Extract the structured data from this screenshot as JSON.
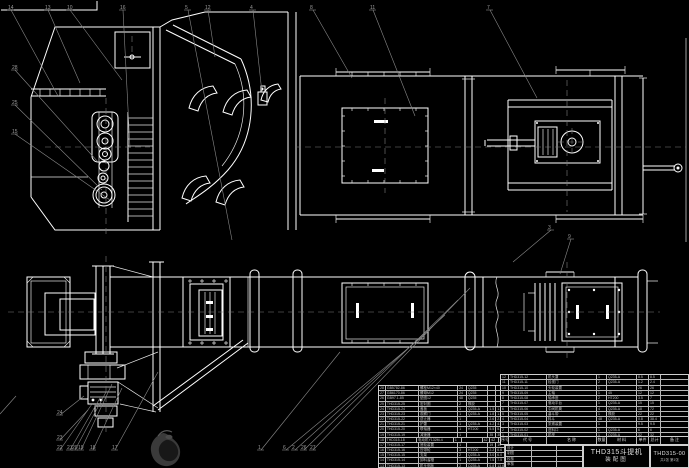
{
  "meta": {
    "background": "#000000",
    "line_color": "#ffffff",
    "callout_color": "#8a8a8a",
    "table_line_color": "#cfcfcf"
  },
  "title_block": {
    "product_title": "THD315斗提机",
    "drawing_type": "装配图",
    "drawing_no": "THD315-00",
    "sheet_info": "共1张 第1张",
    "signature_labels": [
      "设计",
      "制图",
      "校核",
      "审核"
    ]
  },
  "bom": {
    "header": [
      "序号",
      "代 号",
      "名 称",
      "数量",
      "材 料",
      "单件",
      "总计",
      "备 注"
    ],
    "right_rows": [
      {
        "seq": "12",
        "code": "THD315-12",
        "name": "机头罩",
        "qty": "1",
        "material": "Q235-A",
        "w1": "8.5",
        "w2": "8.5",
        "remark": ""
      },
      {
        "seq": "11",
        "code": "THD315-11",
        "name": "检视门",
        "qty": "2",
        "material": "Q235-A",
        "w1": "1.2",
        "w2": "2.4",
        "remark": ""
      },
      {
        "seq": "10",
        "code": "THD315-10",
        "name": "头轮装置",
        "qty": "1",
        "material": "",
        "w1": "26",
        "w2": "26",
        "remark": ""
      },
      {
        "seq": "9",
        "code": "THD315-09",
        "name": "主轴",
        "qty": "1",
        "material": "45",
        "w1": "12",
        "w2": "12",
        "remark": ""
      },
      {
        "seq": "8",
        "code": "THD315-08",
        "name": "轴承座",
        "qty": "2",
        "material": "HT200",
        "w1": "3.5",
        "w2": "7",
        "remark": ""
      },
      {
        "seq": "7",
        "code": "THD315-07",
        "name": "驱动平台",
        "qty": "1",
        "material": "Q235-A",
        "w1": "15",
        "w2": "15",
        "remark": ""
      },
      {
        "seq": "6",
        "code": "THD315-06",
        "name": "中间机筒",
        "qty": "4",
        "material": "Q235-A",
        "w1": "18",
        "w2": "72",
        "remark": ""
      },
      {
        "seq": "5",
        "code": "THD315-05",
        "name": "畚斗带",
        "qty": "1",
        "material": "橡胶",
        "w1": "22",
        "w2": "22",
        "remark": ""
      },
      {
        "seq": "4",
        "code": "THD315-04",
        "name": "料斗",
        "qty": "48",
        "material": "Q235-A",
        "w1": "0.8",
        "w2": "38.4",
        "remark": ""
      },
      {
        "seq": "3",
        "code": "THD315-03",
        "name": "张紧装置",
        "qty": "1",
        "material": "",
        "w1": "9.5",
        "w2": "9.5",
        "remark": ""
      },
      {
        "seq": "2",
        "code": "THD315-02",
        "name": "进料口",
        "qty": "1",
        "material": "Q235-A",
        "w1": "6",
        "w2": "6",
        "remark": ""
      },
      {
        "seq": "1",
        "code": "THD315-01",
        "name": "机座",
        "qty": "1",
        "material": "Q235-A",
        "w1": "32",
        "w2": "32",
        "remark": ""
      }
    ],
    "left_rows": [
      {
        "seq": "28",
        "code": "GB5782-86",
        "name": "螺栓M12×40",
        "qty": "24",
        "material": "Q235",
        "w1": "",
        "w2": "",
        "remark": ""
      },
      {
        "seq": "27",
        "code": "GB6170-86",
        "name": "螺母M12",
        "qty": "24",
        "material": "Q235",
        "w1": "",
        "w2": "",
        "remark": ""
      },
      {
        "seq": "26",
        "code": "GB97.1-85",
        "name": "垫圈12",
        "qty": "48",
        "material": "Q235",
        "w1": "",
        "w2": "",
        "remark": ""
      },
      {
        "seq": "25",
        "code": "THD315-25",
        "name": "密封圈",
        "qty": "2",
        "material": "橡胶",
        "w1": "",
        "w2": "",
        "remark": ""
      },
      {
        "seq": "24",
        "code": "THD315-24",
        "name": "盖板",
        "qty": "1",
        "material": "Q235-A",
        "w1": "1.5",
        "w2": "1.5",
        "remark": ""
      },
      {
        "seq": "23",
        "code": "THD315-23",
        "name": "观察门",
        "qty": "1",
        "material": "Q235-A",
        "w1": "1.8",
        "w2": "1.8",
        "remark": ""
      },
      {
        "seq": "22",
        "code": "THD315-22",
        "name": "逆止器",
        "qty": "1",
        "material": "",
        "w1": "2.6",
        "w2": "2.6",
        "remark": ""
      },
      {
        "seq": "21",
        "code": "THD315-21",
        "name": "护罩",
        "qty": "1",
        "material": "Q235-A",
        "w1": "4.2",
        "w2": "4.2",
        "remark": ""
      },
      {
        "seq": "20",
        "code": "THD315-20",
        "name": "联轴器",
        "qty": "1",
        "material": "HT200",
        "w1": "5.5",
        "w2": "5.5",
        "remark": ""
      },
      {
        "seq": "19",
        "code": "THD315-19",
        "name": "减速器",
        "qty": "1",
        "material": "",
        "w1": "35",
        "w2": "35",
        "remark": ""
      },
      {
        "seq": "18",
        "code": "THD315-18",
        "name": "电动机Y132M-4",
        "qty": "1",
        "material": "",
        "w1": "42",
        "w2": "42",
        "remark": "外购"
      },
      {
        "seq": "17",
        "code": "THD315-17",
        "name": "底轮装置",
        "qty": "1",
        "material": "",
        "w1": "19",
        "w2": "19",
        "remark": ""
      },
      {
        "seq": "16",
        "code": "THD315-16",
        "name": "压带轮",
        "qty": "3",
        "material": "HT200",
        "w1": "2.2",
        "w2": "6.6",
        "remark": ""
      },
      {
        "seq": "15",
        "code": "THD315-15",
        "name": "支架",
        "qty": "2",
        "material": "Q235-A",
        "w1": "3.0",
        "w2": "6.0",
        "remark": ""
      },
      {
        "seq": "14",
        "code": "THD315-14",
        "name": "卸料溜槽",
        "qty": "1",
        "material": "Q235-A",
        "w1": "7.5",
        "w2": "7.5",
        "remark": ""
      },
      {
        "seq": "13",
        "code": "THD315-13",
        "name": "机头侧板",
        "qty": "2",
        "material": "Q235-A",
        "w1": "6.8",
        "w2": "13.6",
        "remark": ""
      }
    ]
  },
  "callouts": [
    {
      "n": "14",
      "x": 8,
      "y": 6,
      "tx": 58,
      "ty": 96
    },
    {
      "n": "13",
      "x": 45,
      "y": 6,
      "tx": 80,
      "ty": 83
    },
    {
      "n": "10",
      "x": 67,
      "y": 6,
      "tx": 122,
      "ty": 80
    },
    {
      "n": "16",
      "x": 120,
      "y": 6,
      "tx": 130,
      "ty": 148
    },
    {
      "n": "5",
      "x": 185,
      "y": 6,
      "tx": 232,
      "ty": 240
    },
    {
      "n": "12",
      "x": 205,
      "y": 6,
      "tx": 215,
      "ty": 57
    },
    {
      "n": "4",
      "x": 250,
      "y": 6,
      "tx": 262,
      "ty": 93
    },
    {
      "n": "8",
      "x": 310,
      "y": 6,
      "tx": 352,
      "ty": 78
    },
    {
      "n": "11",
      "x": 370,
      "y": 6,
      "tx": 415,
      "ty": 116
    },
    {
      "n": "7",
      "x": 487,
      "y": 6,
      "tx": 537,
      "ty": 98
    },
    {
      "n": "3",
      "x": 548,
      "y": 226,
      "tx": 513,
      "ty": 262
    },
    {
      "n": "9",
      "x": 568,
      "y": 235,
      "tx": 560,
      "ty": 274
    },
    {
      "n": "6",
      "x": 283,
      "y": 446,
      "tx": 430,
      "ty": 330
    },
    {
      "n": "2",
      "x": 292,
      "y": 446,
      "tx": 445,
      "ty": 315
    },
    {
      "n": "26",
      "x": 301,
      "y": 446,
      "tx": 458,
      "ty": 300
    },
    {
      "n": "27",
      "x": 310,
      "y": 446,
      "tx": 470,
      "ty": 288
    },
    {
      "n": "1",
      "x": 258,
      "y": 446,
      "tx": 340,
      "ty": 352
    },
    {
      "n": "17",
      "x": 112,
      "y": 446,
      "tx": 158,
      "ty": 372
    },
    {
      "n": "18",
      "x": 90,
      "y": 446,
      "tx": 122,
      "ty": 388
    },
    {
      "n": "19",
      "x": 78,
      "y": 446,
      "tx": 112,
      "ty": 384
    },
    {
      "n": "20",
      "x": 72,
      "y": 446,
      "tx": 106,
      "ty": 392
    },
    {
      "n": "21",
      "x": 67,
      "y": 446,
      "tx": 100,
      "ty": 398
    },
    {
      "n": "22",
      "x": 57,
      "y": 446,
      "tx": 92,
      "ty": 404
    },
    {
      "n": "23",
      "x": 57,
      "y": 436,
      "tx": 88,
      "ty": 410
    },
    {
      "n": "24",
      "x": 57,
      "y": 411,
      "tx": 84,
      "ty": 396
    },
    {
      "n": "28",
      "x": 12,
      "y": 66,
      "tx": 98,
      "ty": 162
    },
    {
      "n": "25",
      "x": 12,
      "y": 101,
      "tx": 102,
      "ty": 190
    },
    {
      "n": "15",
      "x": 12,
      "y": 130,
      "tx": 110,
      "ty": 200
    }
  ]
}
